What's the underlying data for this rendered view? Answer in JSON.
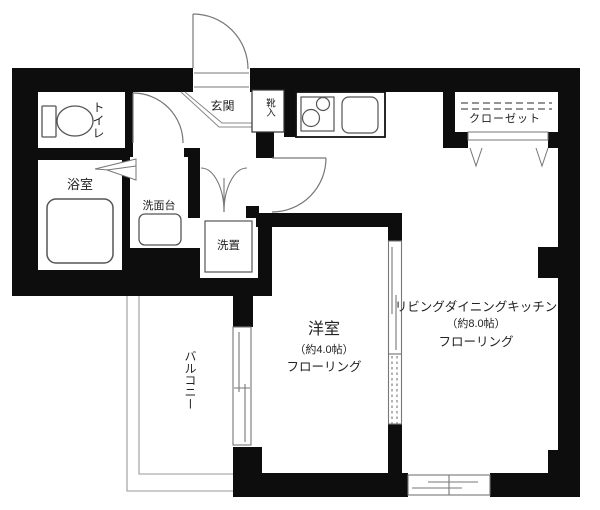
{
  "rooms": {
    "toilet": {
      "label": "トイレ"
    },
    "bath": {
      "label": "浴室"
    },
    "washstand": {
      "label": "洗面台"
    },
    "laundry": {
      "label": "洗置"
    },
    "entrance": {
      "label": "玄関"
    },
    "shoe_box": {
      "label": "靴入"
    },
    "closet": {
      "label": "クローゼット"
    },
    "western_room": {
      "label": "洋室",
      "size": "（約4.0帖）",
      "floor": "フローリング"
    },
    "ldk": {
      "label": "リビングダイニングキッチン",
      "size": "（約8.0帖）",
      "floor": "フローリング"
    },
    "balcony": {
      "label": "バルコニー"
    }
  },
  "icons": [
    "toilet-icon",
    "bathtub-icon",
    "washbasin-icon",
    "washing-machine-space-icon",
    "stove-icon",
    "kitchen-sink-icon",
    "closet-hanger-icon",
    "door-swing-icon",
    "folding-door-icon",
    "sliding-window-icon",
    "balcony-railing-icon"
  ],
  "colors": {
    "wall": "#0d0d0d",
    "line": "#777777",
    "rail": "#999999",
    "text": "#222222",
    "background": "#ffffff"
  }
}
